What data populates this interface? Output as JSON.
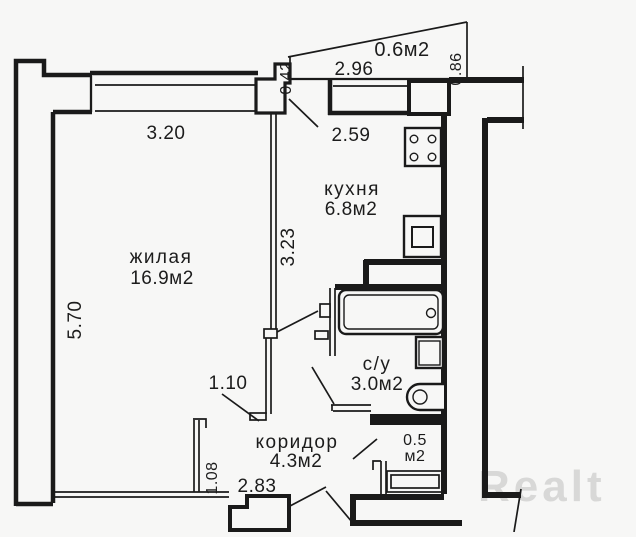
{
  "plan_type": "apartment-floor-plan",
  "rooms": {
    "living": {
      "name": "жилая",
      "area": "16.9м2"
    },
    "kitchen": {
      "name": "кухня",
      "area": "6.8м2"
    },
    "bathroom": {
      "name": "с/у",
      "area": "3.0м2"
    },
    "corridor": {
      "name": "коридор",
      "area": "4.3м2"
    },
    "balcony": {
      "area": "0.6м2"
    },
    "closet": {
      "area_line1": "0.5",
      "area_line2": "м2"
    }
  },
  "dimensions": {
    "living_top_width": "3.20",
    "living_left_height": "5.70",
    "kitchen_top_width": "2.59",
    "kitchen_left_height": "3.23",
    "balcony_width": "2.96",
    "balcony_left_depth": "0.42",
    "balcony_right_depth": "0.86",
    "living_door_width": "1.10",
    "corridor_left_height": "1.08",
    "bottom_width": "2.83"
  },
  "watermark": "Realt",
  "colors": {
    "line": "#1a1a1a",
    "background": "#f7f7f6",
    "watermark": "#d8d8d7"
  }
}
